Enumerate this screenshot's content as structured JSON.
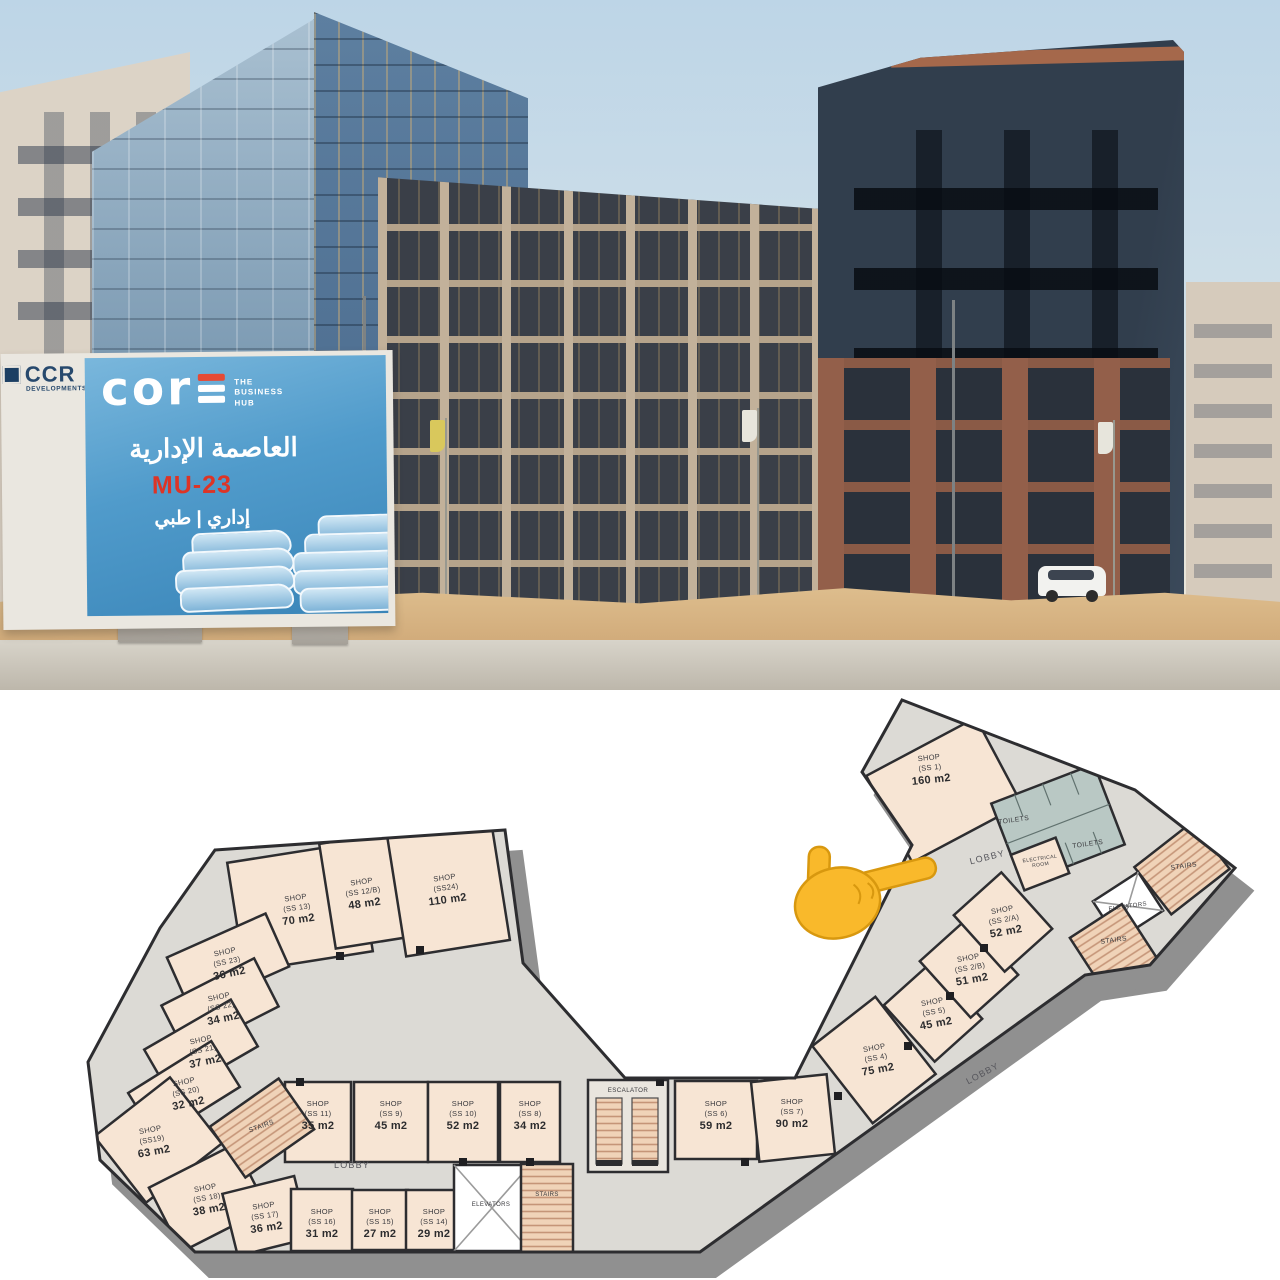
{
  "photo": {
    "billboard": {
      "logo_text": "cor",
      "tagline": "THE BUSINESS HUB",
      "arabic_title": "العاصمة الإدارية",
      "project_code": "MU-23",
      "arabic_subtitle": "إداري | طبي"
    },
    "developer": {
      "name": "CCR",
      "sub": "DEVELOPMENTS"
    }
  },
  "floor_plan": {
    "colors": {
      "room_fill": "#f7e5d4",
      "lobby_fill": "#dcdad5",
      "toilet_fill": "#b9c8c4",
      "stairs_fill": "#f0d3b8",
      "wall": "#2d2d30",
      "edge_band": "#909090",
      "pointer": "#f9b92b"
    },
    "pointer_icon": "pointing-right-hand-emoji",
    "rooms": [
      {
        "label": "SHOP",
        "unit": "(SS 1)",
        "area": "160 m2"
      },
      {
        "label": "SHOP",
        "unit": "(SS 2/A)",
        "area": "52 m2"
      },
      {
        "label": "SHOP",
        "unit": "(SS 2/B)",
        "area": "51 m2"
      },
      {
        "label": "SHOP",
        "unit": "(SS 4)",
        "area": "75 m2"
      },
      {
        "label": "SHOP",
        "unit": "(SS 5)",
        "area": "45 m2"
      },
      {
        "label": "SHOP",
        "unit": "(SS 6)",
        "area": "59 m2"
      },
      {
        "label": "SHOP",
        "unit": "(SS 7)",
        "area": "90 m2"
      },
      {
        "label": "SHOP",
        "unit": "(SS 8)",
        "area": "34 m2"
      },
      {
        "label": "SHOP",
        "unit": "(SS 9)",
        "area": "45 m2"
      },
      {
        "label": "SHOP",
        "unit": "(SS 10)",
        "area": "52 m2"
      },
      {
        "label": "SHOP",
        "unit": "(SS 11)",
        "area": "35 m2"
      },
      {
        "label": "SHOP",
        "unit": "(SS 12/B)",
        "area": "48 m2"
      },
      {
        "label": "SHOP",
        "unit": "(SS 13)",
        "area": "70 m2"
      },
      {
        "label": "SHOP",
        "unit": "(SS 14)",
        "area": "29 m2"
      },
      {
        "label": "SHOP",
        "unit": "(SS 15)",
        "area": "27 m2"
      },
      {
        "label": "SHOP",
        "unit": "(SS 16)",
        "area": "31 m2"
      },
      {
        "label": "SHOP",
        "unit": "(SS 17)",
        "area": "36 m2"
      },
      {
        "label": "SHOP",
        "unit": "(SS 18)",
        "area": "38 m2"
      },
      {
        "label": "SHOP",
        "unit": "(SS19)",
        "area": "63 m2"
      },
      {
        "label": "SHOP",
        "unit": "(SS 20)",
        "area": "32 m2"
      },
      {
        "label": "SHOP",
        "unit": "(SS 21)",
        "area": "37 m2"
      },
      {
        "label": "SHOP",
        "unit": "(SS 22)",
        "area": "34 m2"
      },
      {
        "label": "SHOP",
        "unit": "(SS 23)",
        "area": "36 m2"
      },
      {
        "label": "SHOP",
        "unit": "(SS24)",
        "area": "110 m2"
      }
    ],
    "labels": {
      "lobby": "LOBBY",
      "stairs": "STAIRS",
      "elevators": "ELEVATORS",
      "escalator": "ESCALATOR",
      "toilets": "TOILETS",
      "electrical_1": "ELECTRICAL",
      "electrical_2": "ROOM"
    }
  }
}
